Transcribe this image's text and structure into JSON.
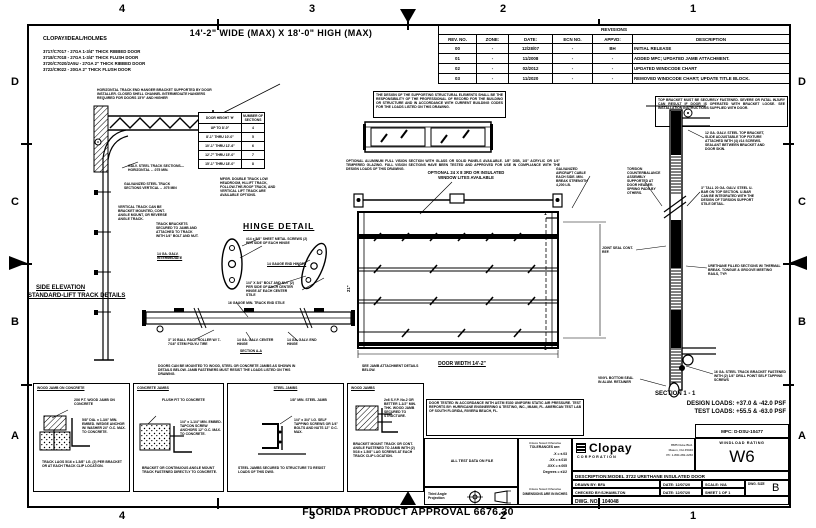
{
  "frame": {
    "cols": [
      "4",
      "3",
      "2",
      "1"
    ],
    "rows": [
      "D",
      "C",
      "B",
      "A"
    ]
  },
  "header": {
    "title": "14'-2\" WIDE (MAX) X 18'-0\" HIGH (MAX)",
    "brand": "CLOPAY/IDEAL/HOLMES",
    "models": [
      "3717/C7017 - 27GA 1-3/4\" THICK RIBBED DOOR",
      "3718/C7018 - 27GA 1-3/4\" THICK FLUSH DOOR",
      "3720/C7020/2A5U - 27GA 2\" THICK RIBBED DOOR",
      "3722/C9022 - 20GA 2\" THICK FLUSH DOOR"
    ]
  },
  "revisions": {
    "title": "REVISIONS",
    "columns": [
      "REV. NO.",
      "ZONE:",
      "DATE:",
      "ECN NO.",
      "APPVD:",
      "DESCRIPTION"
    ],
    "rows": [
      [
        "00",
        "-",
        "12/28/07",
        "-",
        "BH",
        "INITIAL RELEASE"
      ],
      [
        "01",
        "-",
        "11/2008",
        "-",
        "-",
        "ADDED MPC; UPDATED JAMB ATTACHMENT."
      ],
      [
        "02",
        "-",
        "02/2012",
        "-",
        "-",
        "UPDATED WINDCODE CHART"
      ],
      [
        "03",
        "-",
        "11/2020",
        "-",
        "-",
        "REMOVED WINDCODE CHART; UPDATE TITLE BLOCK."
      ]
    ]
  },
  "side": {
    "hanger_note": "HORIZONTAL TRACK END HANGER BRACKET SUPPORTED BY DOOR INSTALLER. CLOSED SHELL CHANNEL INTERMEDIATE HANGERS REQUIRED FOR DOORS 15'9\" AND HIGHER",
    "horiz_note": "GALV. STEEL TRACK SECTIONS— HORIZONTAL – .075 MIN.",
    "vert_note": "GALVANIZED STEEL TRACK SECTIONS VERTICAL – .075 MIN",
    "mount_note": "VERTICAL TRACK CAN BE BRACKET MOUNTED, CONT. ANGLE MOUNT, OR REVERSE ANGLE TRACK.",
    "bracket_note": "TRACK BRACKETS SECURED TO JAMB AND ATTACHED TO TRACK WITH 1/4\" BOLT AND NUT.",
    "intermediate_label": "14 GA. GALV. INTERMEDIATE",
    "title1": "SIDE ELEVATION",
    "title2": "STANDARD-LIFT TRACK DETAILS",
    "options_note": "MFGR. DOUBLE TRACK LOW HEADROOM, HI-LIFT TRACK, FOLLOW-THE-ROOF TRACK, AND VERTICAL LIFT TRACK ARE AVAILABLE OPTIONS."
  },
  "sections_table": {
    "h1": "DOOR HEIGHT 'H'",
    "h2": "NUMBER OF SECTIONS",
    "rows": [
      [
        "UP TO 8'-0\"",
        "4"
      ],
      [
        "8'-1\" THRU 10'-0\"",
        "5"
      ],
      [
        "10'-1\" THRU 12'-6\"",
        "6"
      ],
      [
        "12'-7\" THRU 15'-0\"",
        "7"
      ],
      [
        "15'-1\" THRU 18'-0\"",
        "8"
      ]
    ]
  },
  "hinge": {
    "title": "HINGE DETAIL",
    "screws_note": "#14 x 5/8\" SHEET METAL SCREWS (2) PER SIDE OF EACH HINGE",
    "end_hinges": "14 GAUGE END HINGES",
    "bolt_note": "1/4\" X 3/4\" BOLT AND NUT (2) PER SIDE OF EACH CENTER HINGE AT EACH CENTER STILE",
    "stile_label": "16 GAUGE MIN. TRACK END STILE",
    "roller_label": "3\" 10 BALL RACE ROLLER W/ 7-7/16\" STEM POLYU TIRE",
    "center_hinge_label": "14 GA. GALV. CENTER HINGE",
    "section_aa": "SECTION A-A",
    "end_hinge_label": "14 GA. GALV. END HINGE"
  },
  "door": {
    "struct_note": "THE DESIGN OF THE SUPPORTING STRUCTURAL ELEMENTS SHALL BE THE RESPONSIBILITY OF THE PROFESSIONAL OF RECORD FOR THE BUILDING OR STRUCTURE AND IN ACCORDANCE WITH CURRENT BUILDING CODES FOR THE LOADS LISTED ON THIS DRAWING.",
    "fullvision_note": "OPTIONAL ALUMINUM FULL VISION SECTION WITH GLASS OR SOLID PANELS AVAILABLE. 1/8\" DSB, 1/8\" ACRYLIC OR 1/4\" TEMPERED GLAZING. FULL VISION SECTIONS HAVE BEEN TESTED AND APPROVED FOR USE IN COMPLIANCE WITH THE DESIGN LOADS OF THIS DRAWING.",
    "lites_note": "OPTIONAL 24 X 8 3RD OR INSULATED WINDOW LITES AVAILABLE",
    "width_label": "DOOR WIDTH 14'-2\"",
    "dim21": "21\"",
    "cut_label": "1",
    "cable_note": "GALVANIZED AIRCRAFT CABLE EACH SIDE. MIN. BREAK STRENGTH 4,200 LB.",
    "counterbalance_note": "TORSION COUNTERBALANCE ASSEMBLY SUPPORTED AT DOOR HEADER. SPRING PADS BY OTHERS."
  },
  "section11": {
    "label": "SECTION 1 - 1",
    "warn_note": "TOP BRACKET MUST BE SECURELY FASTENED. SEVERE OR FATAL INJURY CAN RESULT IF DOOR IS OPERATED WITH BRACKET LOOSE. SEE INSTALLATION INSTRUCTIONS SUPPLIED WITH DOOR.",
    "top_note": "12 GA. GALV. STEEL TOP BRACKET, SLIDE ADJUSTABLE TOP FIXTURE ATTACHED WITH (4) #14 SCREWS. SEALANT BETWEEN BRACKET AND DOOR SKIN.",
    "ubar_note": "3\" TALL 20 GA. GALV. STEEL U-BAR ON TOP SECTION. U-BAR CAN BE INTEGRATED WITH THE DESIGN OF TORSION SUPPORT STILE DETAIL.",
    "urethane_note": "URETHANE FILLED SECTIONS W/ THERMAL BREAK. TONGUE & GROOVE MEETING RAILS, TYP.",
    "bracket_note": "16 GA. STEEL TRACK BRACKET FASTENED WITH (2) 1/4\" DRILL POINT SELF TAPPING SCREWS",
    "seal_note": "VINYL BOTTOM SEAL IN ALUM. RETAINER",
    "joint_note": "JOINT SEAL CONT. REF."
  },
  "jambs": {
    "note_left": "DOORS CAN BE MOUNTED TO WOOD, STEEL OR CONCRETE JAMBS AS SHOWN IN DETAILS BELOW. JAMB FASTENERS MUST RESIST THE LOADS LISTED ON THIS DRAWING.",
    "note_right": "SEE JAMB ATTACHMENT DETAILS BELOW.",
    "panels": [
      {
        "title": "WOOD JAMB ON CONCRETE",
        "n1": "2X6 P.T. WOOD JAMB ON CONCRETE",
        "n2": "5/8\" DIA. x 1-3/4\" MIN. EMBED. WEDGE ANCHOR W/ WASHER 24\" O.C. MAX. TO CONCRETE.",
        "n3": "TRACK LAGS 5/16 x 1-5/8\" LG. (2) PER BRACKET OR AT EACH TRACK CLIP LOCATION."
      },
      {
        "title": "CONCRETE JAMBS",
        "n1": "FLUSH FIT TO CONCRETE",
        "n2": "1/4\" x 1-1/4\" MIN. EMBED. TAPCON SCREW ANCHORS 12\" O.C. MAX. TO CONCRETE.",
        "n3": "BRACKET OR CONTINUOUS ANGLE MOUNT TRACK FASTENED DIRECTLY TO CONCRETE."
      },
      {
        "title": "STEEL JAMBS",
        "n1": "1/8\" MIN. STEEL JAMB",
        "n2": "1/4\" x 3/4\" LG. SELF TAPPING SCREWS OR 1/4\" BOLTS AND NUTS 12\" O.C. MAX.",
        "n3": "STEEL JAMBS SECURED TO STRUCTURE TO RESIST LOADS OF THIS DWG."
      },
      {
        "title": "WOOD JAMBS",
        "n1": "2x6 S.Y.P. No.2 OR BETTER 1-1/2\" MIN. THK. WOOD JAMB SECURED TO STRUCTURE.",
        "n2": "BRACKET MOUNT TRACK OR CONT. ANGLE FASTENED TO JAMB WITH (2) 5/16 x 1-5/8\" LAG SCREWS AT EACH TRACK CLIP LOCATION."
      }
    ]
  },
  "loads": {
    "design": "DESIGN LOADS: +37.0 & -42.0 PSF",
    "test": "TEST LOADS: +55.5 & -63.0 PSF"
  },
  "title_block": {
    "cert_note": "DOOR TESTED IN ACCORDANCE WITH ASTM E330 UNIFORM STATIC AIR PRESSURE. TEST REPORTS BY: HURRICANE ENGINEERING & TESTING, INC., MIAMI, FL. AMERICAN TEST LAB OF SOUTH FLORIDA, RIVIERA BEACH, FL.",
    "mpc": "MPC: D-DSU-10477",
    "windload_label": "WINDLOAD RATING",
    "windload_value": "W6",
    "brand": "Clopay",
    "brand_sub": "CORPORATION",
    "addr1": "8585 Duke Blvd.",
    "addr2": "Mason, OH 45040",
    "addr3": "Ph: 1-800-282-2260",
    "desc": "DESCRIPTION:MODEL 3722 URETHANE INSULATED DOOR",
    "drawn": "DRAWN BY: BFA",
    "drawn_date": "DATE: 12/07/20",
    "scale": "SCALE: N/A",
    "checked": "CHECKED BY:SJHAMILTON",
    "checked_date": "DATE: 12/07/20",
    "sheet": "SHEET 1 OF 1",
    "size_label": "DWG. SIZE",
    "size_value": "B",
    "dwg_no": "DWG. NO.:  104048",
    "tol_header1": "Unless Noted Otherwise",
    "tol_header2": "TOLERANCES are:",
    "tols": [
      ".X = ±.03",
      ".XX = ±.010",
      ".XXX = ±.005",
      "Degrees = ±1/2"
    ],
    "dim_note1": "Unless Noted Otherwise",
    "dim_note2": "DIMENSIONS ARE IN INCHES",
    "proj_label": "Third Angle Projection",
    "note_cell": "ALL TEST DATA ON FILE"
  },
  "florida": "FLORIDA PRODUCT APPROVAL 6676.30"
}
